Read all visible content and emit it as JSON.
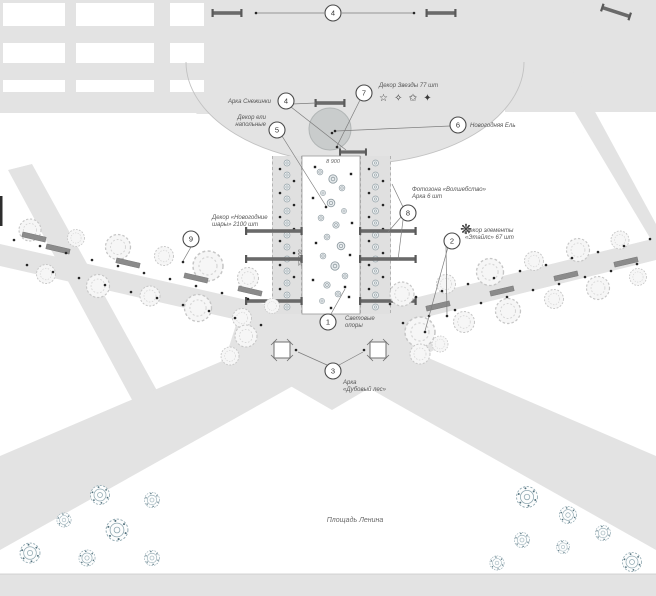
{
  "plan_title": "Площадь Ленина",
  "dimensions": {
    "corridor_width": "8 900",
    "corridor_length": "32 000"
  },
  "callouts": [
    {
      "num": "1",
      "label_lines": [
        "Световые",
        "опоры"
      ]
    },
    {
      "num": "2",
      "label_lines": [
        "Декор элементы",
        "«Этайлс» 67 шт"
      ]
    },
    {
      "num": "3",
      "label_lines": [
        "Арка",
        "«Дубовый лес»"
      ]
    },
    {
      "num": "4",
      "label_lines": [
        "Арка Снежинки"
      ]
    },
    {
      "num": "5",
      "label_lines": [
        "Декор ели",
        "напольные"
      ]
    },
    {
      "num": "6",
      "label_lines": [
        "Новогодняя Ель"
      ]
    },
    {
      "num": "7",
      "label_lines": [
        "Декор Звезды 77 шт"
      ]
    },
    {
      "num": "8",
      "label_lines": [
        "Фотозона «Волшебство»",
        "Арка 6 шт"
      ]
    },
    {
      "num": "9",
      "label_lines": [
        "Декор «Новогодние",
        "шары» 2100 шт"
      ]
    }
  ],
  "icons": {
    "stars_glyphs": "☆ ✧ ✩ ✦",
    "snowflake_glyph": "❋"
  },
  "colors": {
    "road_gray": "#e3e3e3",
    "white_area": "#ffffff",
    "tree_ring": "#8fa7b0",
    "bench_gray": "#8b8b8b",
    "arch_dark": "#6a6a6a",
    "new_year_tree": "#c9cccc",
    "callout_stroke": "#4a4a4a"
  }
}
